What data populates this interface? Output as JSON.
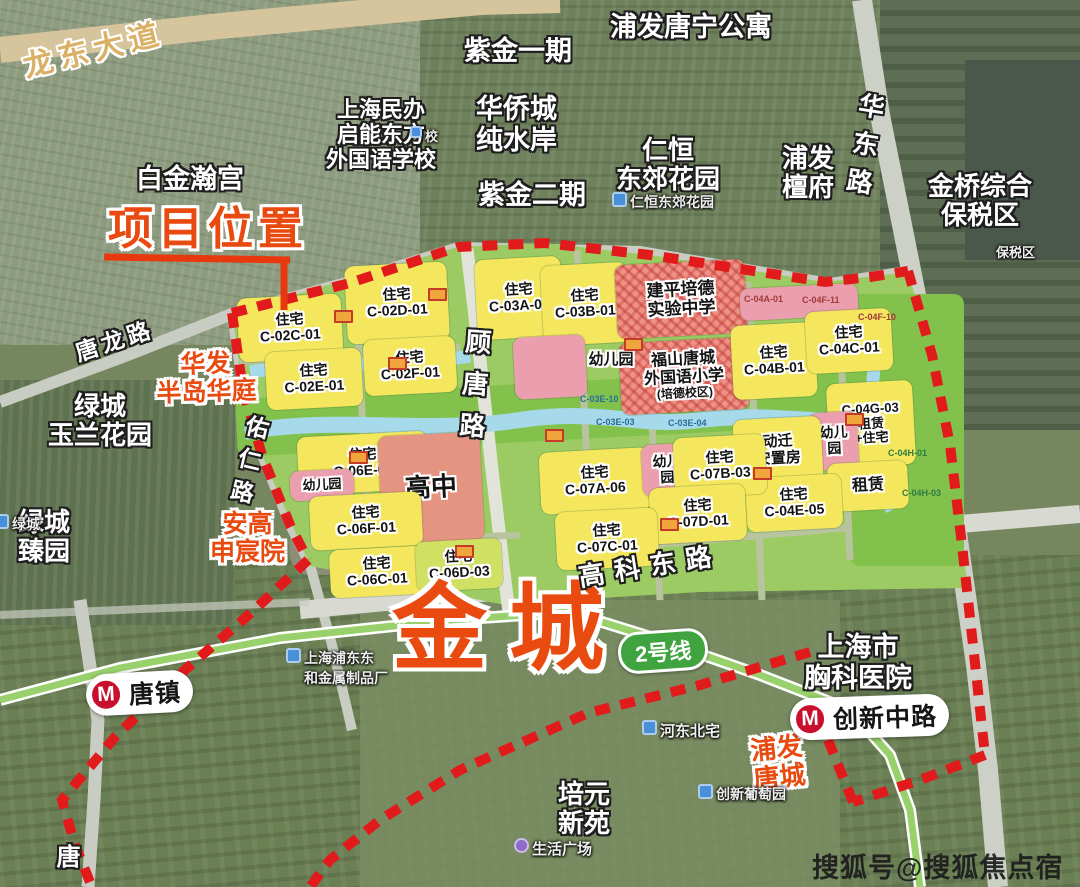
{
  "project": {
    "location_label": "项目位置",
    "name_overlay": "金城"
  },
  "watermark": "搜狐号@搜狐焦点宿州站",
  "metro": {
    "line_badge": "2号线",
    "station_tangzhen": "唐镇",
    "station_chuangxin": "创新中路",
    "logo_letter": "M"
  },
  "roads": {
    "longdong": "龙东大道",
    "tanglong": "唐龙路",
    "gutang": "顾唐路",
    "youren": "佑仁路",
    "gaoke": "高科东路",
    "huadong": "华东路",
    "tang_partial": "唐"
  },
  "landmarks": {
    "baijin": "白金瀚宫",
    "qineng": "上海民办\n启能东方\n外国语学校",
    "zijin1": "紫金一期",
    "pufa_tangning": "浦发唐宁公寓",
    "huaqiaocheng": "华侨城\n纯水岸",
    "zijin2": "紫金二期",
    "renheng": "仁恒\n东郊花园",
    "pufa_tanfu": "浦发\n檀府",
    "jinqiao": "金桥综合\n保税区",
    "huafa": "华发\n半岛华庭",
    "lvcheng_yulan": "绿城\n玉兰花园",
    "lvcheng_zhen": "绿城\n臻园",
    "angao": "安高\n申宸院",
    "xiongke": "上海市\n胸科医院",
    "pufa_tangcheng": "浦发\n唐城",
    "peiyuan": "培元\n新苑"
  },
  "pois": {
    "renheng_small": "仁恒东郊花园",
    "metal_factory": "上海浦东东\n和金属制品厂",
    "hedong": "河东北宅",
    "putaoyuan": "创新葡萄园",
    "shenghuo": "生活广场",
    "lvcheng_small": "绿城",
    "school_small": "校",
    "baoshui_small": "保税区"
  },
  "parcels": [
    {
      "label": "住宅\nC-02C-01"
    },
    {
      "label": "住宅\nC-02D-01"
    },
    {
      "label": "住宅\nC-02E-01"
    },
    {
      "label": "住宅\nC-02F-01"
    },
    {
      "label": "住宅\nC-03A-01"
    },
    {
      "label": "住宅\nC-03B-01"
    },
    {
      "label": "建平培德\n实验中学"
    },
    {
      "label": "福山唐城\n外国语小学",
      "sub": "(培德校区)"
    },
    {
      "label": "幼儿园"
    },
    {
      "label": "住宅\nC-04B-01"
    },
    {
      "label": "住宅\nC-04C-01"
    },
    {
      "label": "C-04G-03\n租赁\n+住宅"
    },
    {
      "label": "幼儿\n园"
    },
    {
      "label": "租赁"
    },
    {
      "label": "动迁\n安置房"
    },
    {
      "label": "住宅\nC-04E-05"
    },
    {
      "label": "住宅\nC-06E-01"
    },
    {
      "label": "幼儿园"
    },
    {
      "label": "高中"
    },
    {
      "label": "住宅\nC-06F-01"
    },
    {
      "label": "住宅\nC-06C-01"
    },
    {
      "label": "住宅\nC-06D-03"
    },
    {
      "label": "住宅\nC-07A-06"
    },
    {
      "label": "幼儿\n园"
    },
    {
      "label": "住宅\nC-07B-03"
    },
    {
      "label": "住宅\nC-07D-01"
    },
    {
      "label": "住宅\nC-07C-01"
    }
  ],
  "tiny_codes": [
    "C-04A-01",
    "C-04F-11",
    "C-04F-10",
    "C-03E-10",
    "C-03E-03",
    "C-03E-04",
    "C-04H-01",
    "C-04H-03"
  ],
  "colors": {
    "boundary": "#e11b1b",
    "highlight": "#e94a10",
    "parcel_yellow": "#f4e75d",
    "parcel_green": "#82c24c",
    "water": "#a6d9e9",
    "kindergarten_pink": "#eb9fae",
    "school_red": "#ef9184",
    "metro_green": "#98d06c",
    "badge_green": "#3fa33f",
    "road_tan": "#d6c49c"
  }
}
